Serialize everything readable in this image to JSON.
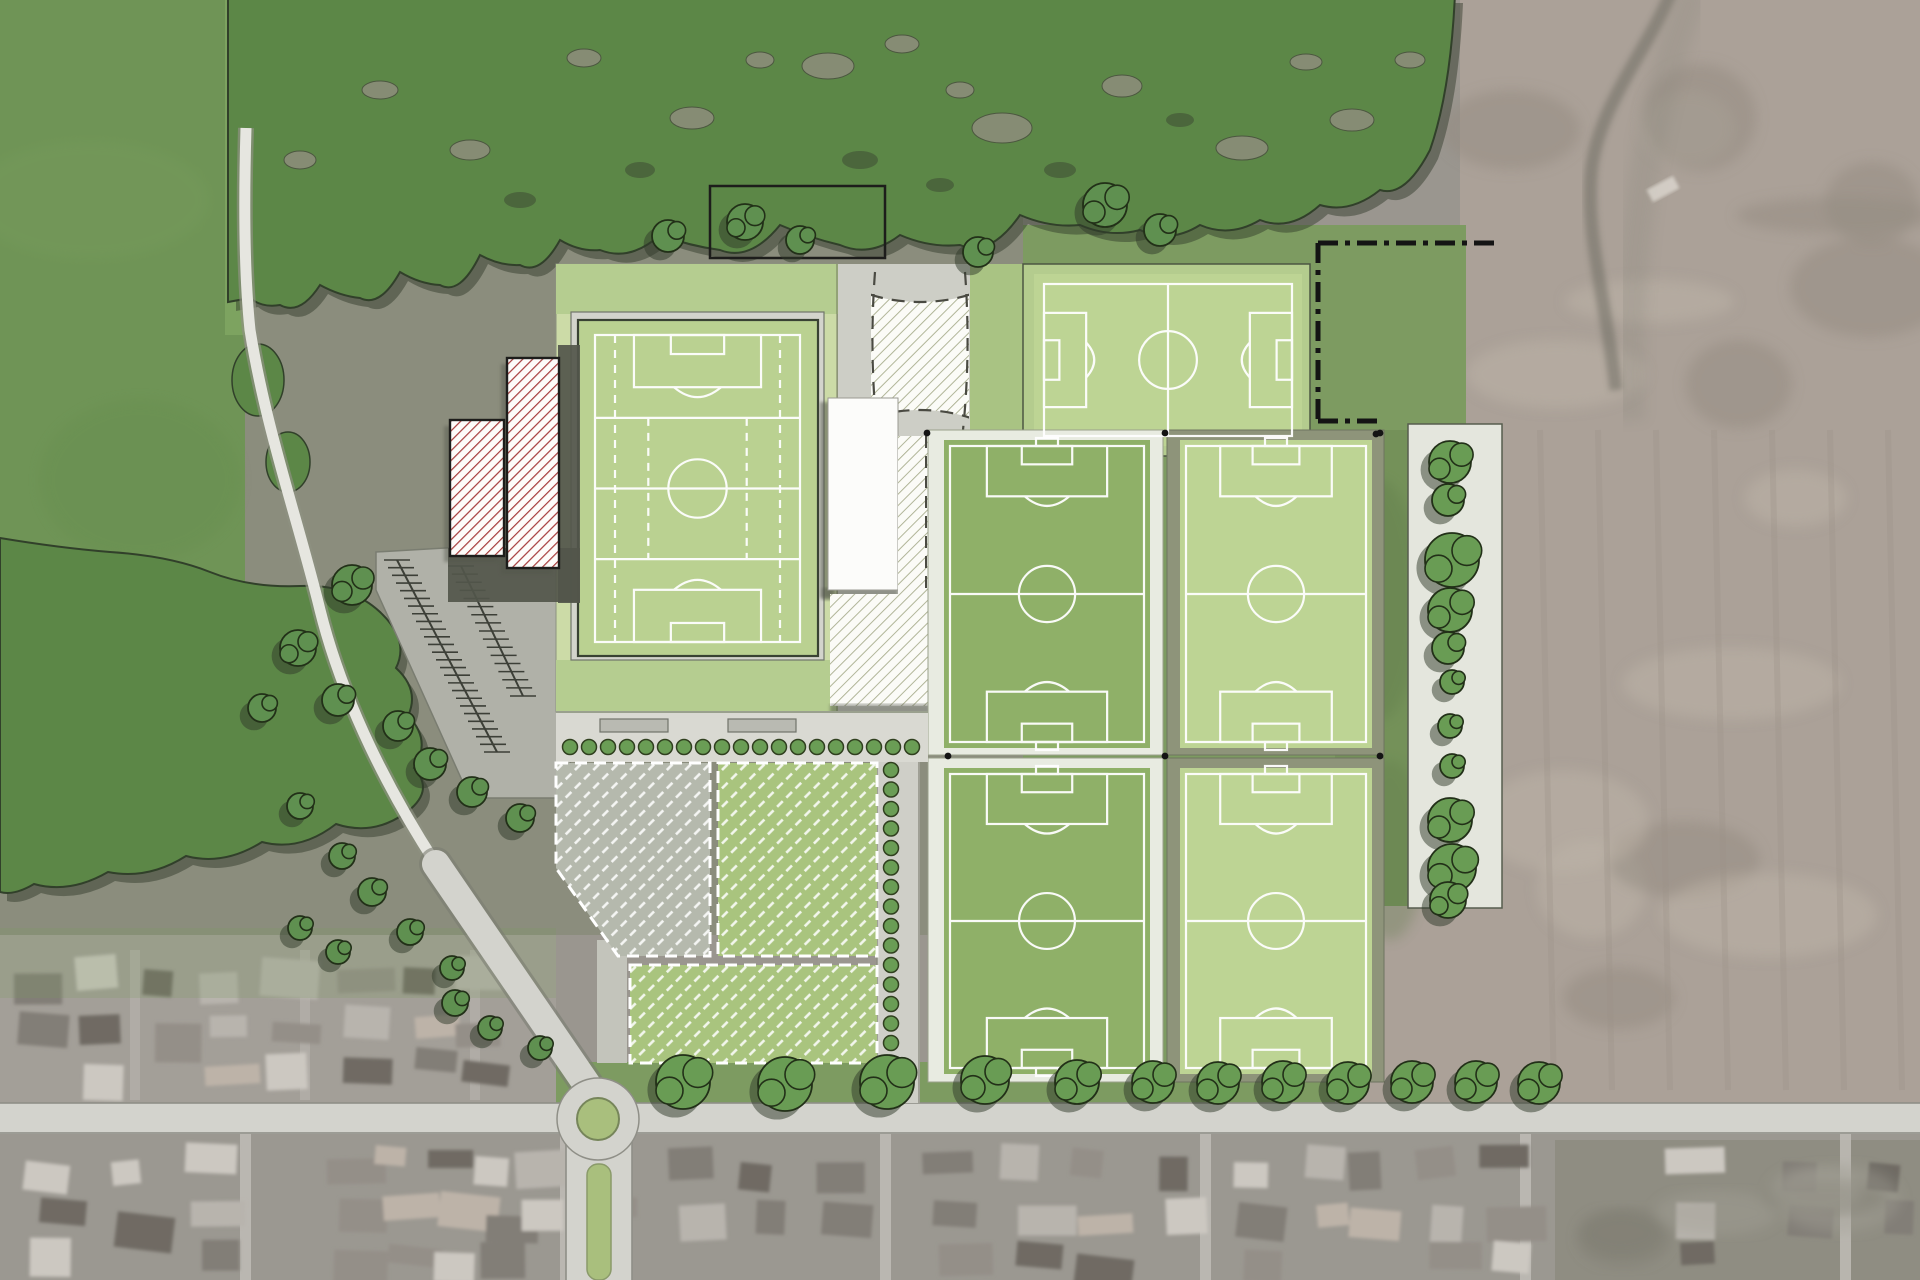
{
  "scene": {
    "kind": "sports-complex-masterplan-aerial",
    "palette": {
      "aerial": "#9a968f",
      "innerGround": "#8b8d7d",
      "farm": "#aba198",
      "farmLight": "#bdb3a8",
      "farmDark": "#948b81",
      "suburb": "#9b9891",
      "suburbN": "#a39f98",
      "paddock": "#8f8d82",
      "fieldGreen": "#6f9456",
      "forest": "#5c8747",
      "forestShadow": "#2c3626",
      "canopyGap": "#8b8d79",
      "siteGreen": "#7d9b61",
      "lawn": "#a9c383",
      "platform": "#ccdba7",
      "bandGreen": "#b5cd90",
      "concourse": "#d3d4cc",
      "enclosure": "#bad191",
      "pitchLight": "#bdd494",
      "pitchMedium": "#8fb068",
      "frameWhite": "#e8ebe1",
      "frameOlive": "#8e947a",
      "line": "#ffffff",
      "plaza": "#cdcec6",
      "hatchLine": "#a9ae8e",
      "white": "#fcfcfa",
      "redHatch": "#a63b3b",
      "dark": "#53564b",
      "outline": "#1d1d1b",
      "road": "#d3d3cd",
      "roadEdge": "#8f8f87",
      "path": "#e6e6e0",
      "promenade": "#d9d9d2",
      "planter": "#b9bab2",
      "plotGray": "#b5b9ad",
      "plotGreen": "#a9c47e",
      "tree": "#699c54",
      "treeDark": "#5f9050",
      "treeOutline": "#223018",
      "shadow": "#2f3a2a",
      "island": "#a9bf7d",
      "stripBg": "#e4e6dd",
      "shrub": "#55663f"
    },
    "pitches": [
      {
        "id": "stadium-pitch",
        "x": 595,
        "y": 335,
        "w": 205,
        "h": 307,
        "orientation": "portrait",
        "style": "stadium"
      },
      {
        "id": "north-pitch",
        "x": 1044,
        "y": 284,
        "w": 248,
        "h": 152,
        "orientation": "landscape",
        "style": "north"
      },
      {
        "id": "pitch-nw",
        "x": 950,
        "y": 446,
        "w": 194,
        "h": 296,
        "orientation": "portrait",
        "style": "grid"
      },
      {
        "id": "pitch-ne",
        "x": 1186,
        "y": 446,
        "w": 180,
        "h": 296,
        "orientation": "portrait",
        "style": "grid"
      },
      {
        "id": "pitch-sw",
        "x": 950,
        "y": 774,
        "w": 194,
        "h": 294,
        "orientation": "portrait",
        "style": "grid"
      },
      {
        "id": "pitch-se",
        "x": 1186,
        "y": 774,
        "w": 180,
        "h": 294,
        "orientation": "portrait",
        "style": "grid"
      }
    ],
    "corner_dots": [
      [
        927,
        433
      ],
      [
        1165,
        433
      ],
      [
        1380,
        433
      ],
      [
        948,
        756
      ],
      [
        1165,
        756
      ],
      [
        1380,
        756
      ]
    ],
    "boundary": {
      "path": "M1318,243 H1500 M1318,243 V421 M1318,421 H1382",
      "dash": "20 7 5 7",
      "dot": [
        1376,
        434
      ]
    },
    "parking": {
      "spines": [
        [
          397,
          560,
          497,
          752
        ],
        [
          461,
          566,
          523,
          696
        ]
      ],
      "tick_len": 26,
      "step": 8.5
    },
    "trees": {
      "street_row": [
        [
          683,
          1082,
          27
        ],
        [
          785,
          1084,
          27
        ],
        [
          887,
          1082,
          27
        ],
        [
          985,
          1080,
          24
        ],
        [
          1077,
          1082,
          22
        ],
        [
          1153,
          1082,
          21
        ],
        [
          1218,
          1083,
          21
        ],
        [
          1283,
          1082,
          21
        ],
        [
          1348,
          1083,
          21
        ],
        [
          1412,
          1082,
          21
        ],
        [
          1476,
          1082,
          21
        ],
        [
          1539,
          1083,
          21
        ]
      ],
      "scattered": [
        [
          352,
          585,
          20
        ],
        [
          298,
          648,
          18
        ],
        [
          338,
          700,
          16
        ],
        [
          262,
          708,
          14
        ],
        [
          398,
          726,
          15
        ],
        [
          430,
          764,
          16
        ],
        [
          472,
          792,
          15
        ],
        [
          520,
          818,
          14
        ],
        [
          300,
          806,
          13
        ],
        [
          342,
          856,
          13
        ],
        [
          372,
          892,
          14
        ],
        [
          410,
          932,
          13
        ],
        [
          300,
          928,
          12
        ],
        [
          338,
          952,
          12
        ],
        [
          452,
          968,
          12
        ],
        [
          455,
          1003,
          13
        ],
        [
          490,
          1028,
          12
        ],
        [
          540,
          1048,
          12
        ],
        [
          668,
          236,
          16
        ],
        [
          978,
          252,
          15
        ],
        [
          745,
          222,
          18
        ],
        [
          800,
          240,
          14
        ],
        [
          1105,
          205,
          22
        ],
        [
          1160,
          230,
          16
        ]
      ],
      "right_strip": [
        [
          1450,
          462,
          21
        ],
        [
          1448,
          500,
          16
        ],
        [
          1452,
          560,
          27
        ],
        [
          1450,
          610,
          22
        ],
        [
          1448,
          648,
          16
        ],
        [
          1452,
          682,
          12
        ],
        [
          1450,
          726,
          12
        ],
        [
          1452,
          766,
          12
        ],
        [
          1450,
          820,
          22
        ],
        [
          1452,
          868,
          24
        ],
        [
          1448,
          900,
          18
        ]
      ],
      "promenade_row": {
        "x0": 570,
        "y": 747,
        "step": 19,
        "count": 19,
        "r": 7.5
      },
      "walk_column": {
        "x": 891,
        "y0": 770,
        "step": 19.5,
        "count": 15,
        "r": 7.5
      }
    },
    "forest_gaps": [
      [
        828,
        66,
        26,
        13
      ],
      [
        902,
        44,
        17,
        9
      ],
      [
        1002,
        128,
        30,
        15
      ],
      [
        1122,
        86,
        20,
        11
      ],
      [
        1242,
        148,
        26,
        12
      ],
      [
        1306,
        62,
        16,
        8
      ],
      [
        692,
        118,
        22,
        11
      ],
      [
        584,
        58,
        17,
        9
      ],
      [
        1352,
        120,
        22,
        11
      ],
      [
        1410,
        60,
        15,
        8
      ],
      [
        470,
        150,
        20,
        10
      ],
      [
        380,
        90,
        18,
        9
      ],
      [
        300,
        160,
        16,
        9
      ],
      [
        960,
        90,
        14,
        8
      ],
      [
        760,
        60,
        14,
        8
      ]
    ],
    "forest_spots": [
      [
        860,
        160,
        18,
        9
      ],
      [
        940,
        185,
        14,
        7
      ],
      [
        1060,
        170,
        16,
        8
      ],
      [
        640,
        170,
        15,
        8
      ],
      [
        520,
        200,
        16,
        8
      ],
      [
        1180,
        120,
        14,
        7
      ]
    ],
    "planters": [
      [
        600,
        719,
        68,
        13
      ],
      [
        728,
        719,
        68,
        13
      ]
    ],
    "texture_seed": 9
  }
}
